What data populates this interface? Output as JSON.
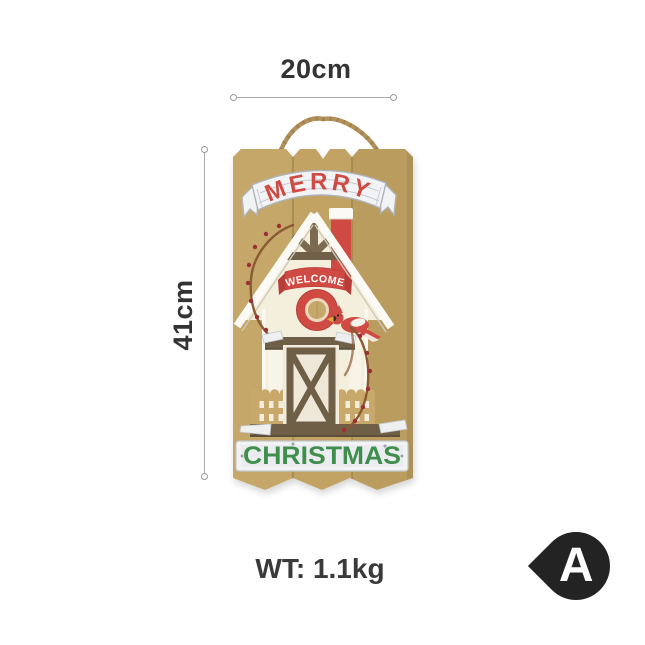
{
  "annotations": {
    "width_label": "20cm",
    "height_label": "41cm",
    "weight_label": "WT: 1.1kg"
  },
  "badge": {
    "label": "A",
    "color": "#232323"
  },
  "sign": {
    "banner_text": "MERRY",
    "welcome_text": "WELCOME",
    "plaque_text": "CHRISTMAS",
    "colors": {
      "board": "#c2a364",
      "board_gap": "#9c8349",
      "red": "#d04a44",
      "green": "#3f8e4d",
      "silver": "#f2f3f5",
      "silver_edge": "#aeb3bb",
      "cream": "#f4eedd",
      "brown": "#6e5f46",
      "timber": "#7b6a50",
      "rope": "#b2925a",
      "vine": "#8a5a33",
      "berry": "#9c2f36",
      "white_trim": "#fbfaf4"
    }
  }
}
